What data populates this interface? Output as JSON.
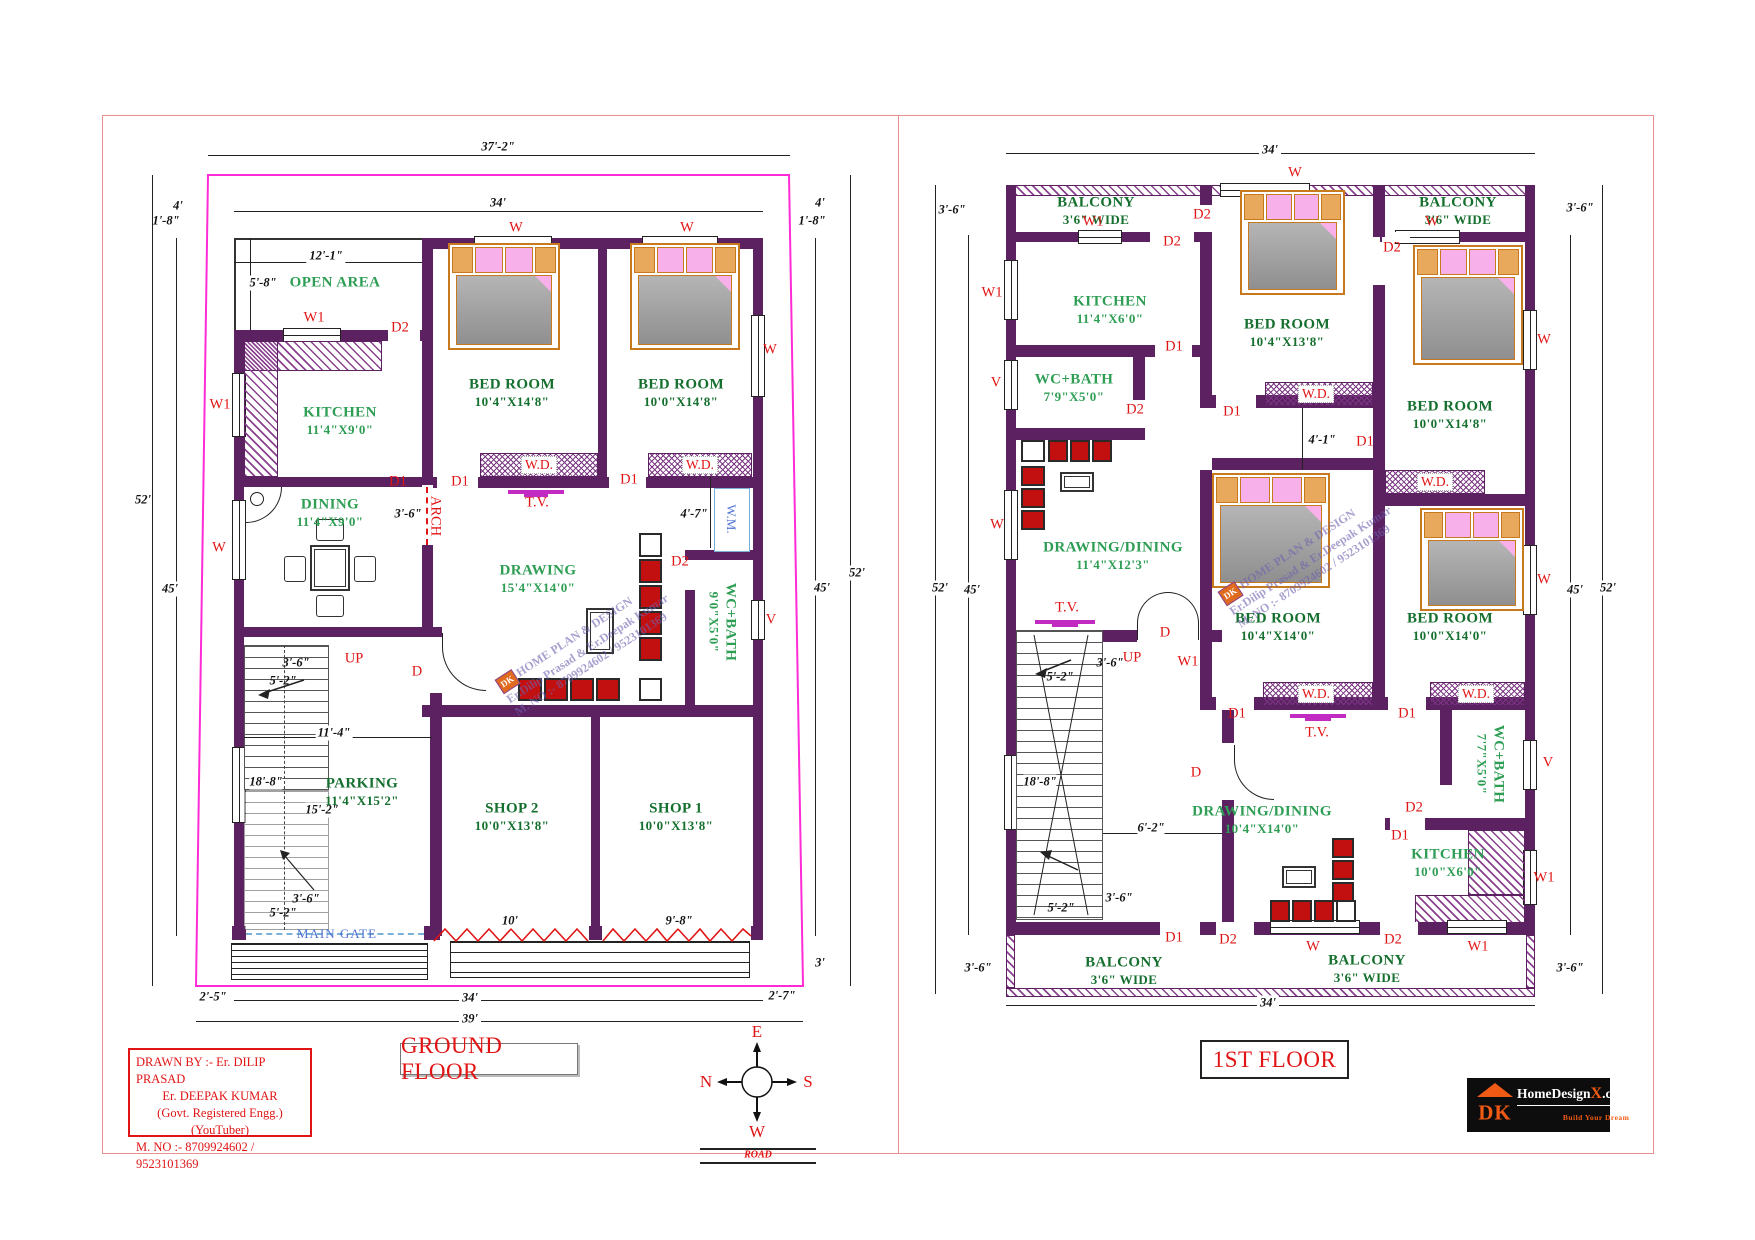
{
  "legend": {
    "w": "W",
    "w1": "W1",
    "v": "V",
    "d": "D",
    "d1": "D1",
    "d2": "D2",
    "wd": "W.D.",
    "tv": "T.V.",
    "wm": "W.M.",
    "up": "UP",
    "arch": "ARCH",
    "main_gate": "MAIN GATE",
    "road": "ROAD"
  },
  "dims": {
    "d37_2": "37'-2\"",
    "d34": "34'",
    "d39": "39'",
    "d52": "52'",
    "d45": "45'",
    "d4": "4'",
    "d1_8": "1'-8\"",
    "d12_1": "12'-1\"",
    "d5_8": "5'-8\"",
    "d3_6": "3'-6\"",
    "d4_7": "4'-7\"",
    "d4_1": "4'-1\"",
    "d11_4": "11'-4\"",
    "d18_8": "18'-8\"",
    "d15_2": "15'-2\"",
    "d5_2": "5'-2\"",
    "d6_2": "6'-2\"",
    "d10": "10'",
    "d9_8": "9'-8\"",
    "d2_5": "2'-5\"",
    "d2_7": "2'-7\"",
    "d3": "3'"
  },
  "gf": {
    "title": "GROUND FLOOR",
    "open_area": "OPEN AREA",
    "kitchen": {
      "n": "KITCHEN",
      "s": "11'4\"X9'0\""
    },
    "dining": {
      "n": "DINING",
      "s": "11'4\"X9'0\""
    },
    "bed1": {
      "n": "BED ROOM",
      "s": "10'4\"X14'8\""
    },
    "bed2": {
      "n": "BED ROOM",
      "s": "10'0\"X14'8\""
    },
    "drawing": {
      "n": "DRAWING",
      "s": "15'4\"X14'0\""
    },
    "wcbath": {
      "n": "WC+BATH",
      "s": "9'0\"X5'0\""
    },
    "parking": {
      "n": "PARKING",
      "s": "11'4\"X15'2\""
    },
    "shop2": {
      "n": "SHOP 2",
      "s": "10'0\"X13'8\""
    },
    "shop1": {
      "n": "SHOP 1",
      "s": "10'0\"X13'8\""
    }
  },
  "ff": {
    "title": "1ST FLOOR",
    "balcony": {
      "n": "BALCONY",
      "s": "3'6\" WIDE"
    },
    "kitchen1": {
      "n": "KITCHEN",
      "s": "11'4\"X6'0\""
    },
    "wcbath1": {
      "n": "WC+BATH",
      "s": "7'9\"X5'0\""
    },
    "bed_tc": {
      "n": "BED ROOM",
      "s": "10'4\"X13'8\""
    },
    "bed_tr": {
      "n": "BED ROOM",
      "s": "10'0\"X14'8\""
    },
    "dd1": {
      "n": "DRAWING/DINING",
      "s": "11'4\"X12'3\""
    },
    "bed_mc": {
      "n": "BED ROOM",
      "s": "10'4\"X14'0\""
    },
    "bed_mr": {
      "n": "BED ROOM",
      "s": "10'0\"X14'0\""
    },
    "wcbath2": {
      "n": "WC+BATH",
      "s": "7'7\"X5'0\""
    },
    "dd2": {
      "n": "DRAWING/DINING",
      "s": "10'4\"X14'0\""
    },
    "kitchen2": {
      "n": "KITCHEN",
      "s": "10'0\"X6'0\""
    }
  },
  "compass": {
    "e": "E",
    "n": "N",
    "s": "S",
    "w": "W"
  },
  "info_box": {
    "l1": "DRAWN BY :- Er. DILIP PRASAD",
    "l2": "Er. DEEPAK KUMAR",
    "l3": "(Govt. Registered Engg.)",
    "l4": "(YouTuber)",
    "l5": "M. NO :- 8709924602 / 9523101369"
  },
  "watermark": {
    "badge": "DK",
    "l1": "HOME PLAN & DESIGN",
    "l2": "Er.Dilip Prasad & Er.Deepak Kumar",
    "l3": "M. NO :- 8709924602 / 9523101369"
  },
  "logo": {
    "dk": "DK",
    "name": "HomeDesign",
    "x": "X",
    "com": ".com",
    "tagline": "Build Your Dream"
  },
  "colors": {
    "wall": "#5c2161",
    "accent_red": "#e01414",
    "green_dark": "#156f2e",
    "green": "#2f9e55",
    "magenta": "#ff2bd6",
    "blue": "#4f74d2",
    "orange": "#f05a14"
  }
}
